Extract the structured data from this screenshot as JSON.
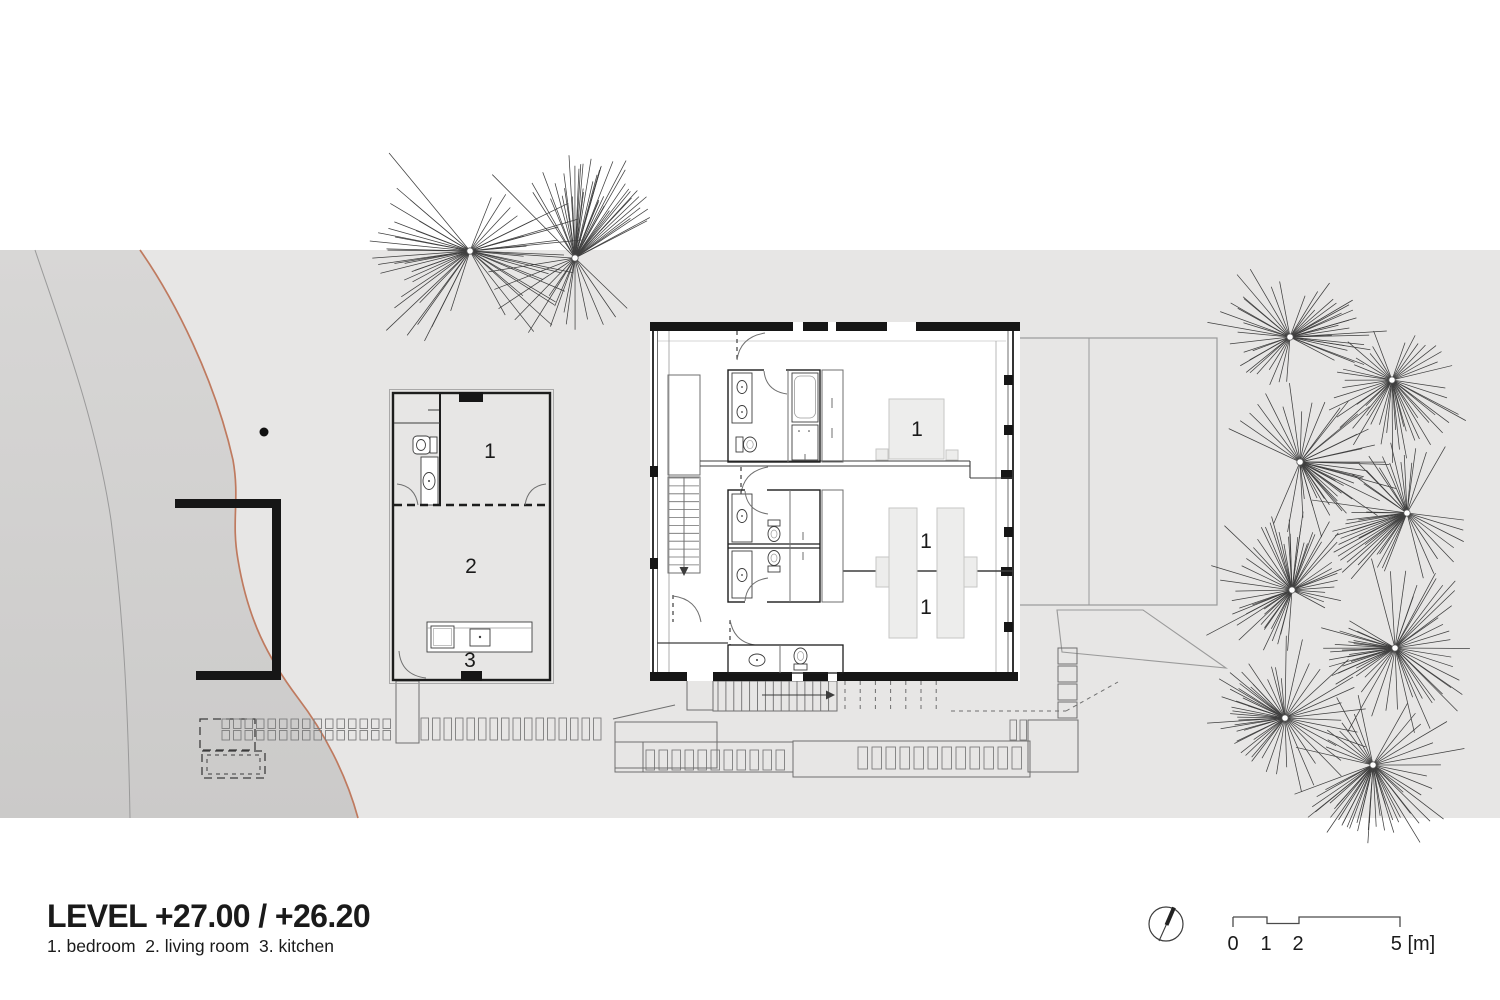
{
  "plan": {
    "title": "LEVEL +27.00 / +26.20",
    "legend": "1. bedroom  2. living room  3. kitchen",
    "rooms": {
      "small_house": {
        "bedroom": "1",
        "living_room": "2",
        "kitchen": "3"
      },
      "main_house": {
        "bedroom_top": "1",
        "bedroom_mid": "1",
        "bedroom_bottom": "1"
      }
    },
    "scale_bar": {
      "tick_0": "0",
      "tick_1": "1",
      "tick_2": "2",
      "tick_5": "5 [m]"
    },
    "colors": {
      "site_band": "#e7e6e5",
      "terrain_dark": "#cbcac9",
      "terrain_dark2": "#d8d7d6",
      "contour_orange": "#bf7a5f",
      "wall_black": "#161616",
      "line_dark": "#3d3d3d",
      "line_mid": "#6f6f6f",
      "line_light": "#9a9a9a",
      "fill_furniture": "#ededec",
      "furniture_stroke": "#c6c6c5"
    },
    "trees": {
      "top": [
        [
          470,
          251,
          1.3
        ],
        [
          575,
          258,
          1.25
        ]
      ],
      "right": [
        [
          1290,
          337,
          1
        ],
        [
          1392,
          380,
          1
        ],
        [
          1300,
          462,
          1
        ],
        [
          1407,
          513,
          1
        ],
        [
          1292,
          590,
          1
        ],
        [
          1395,
          648,
          1
        ],
        [
          1285,
          718,
          1
        ],
        [
          1373,
          765,
          1.05
        ]
      ]
    }
  }
}
